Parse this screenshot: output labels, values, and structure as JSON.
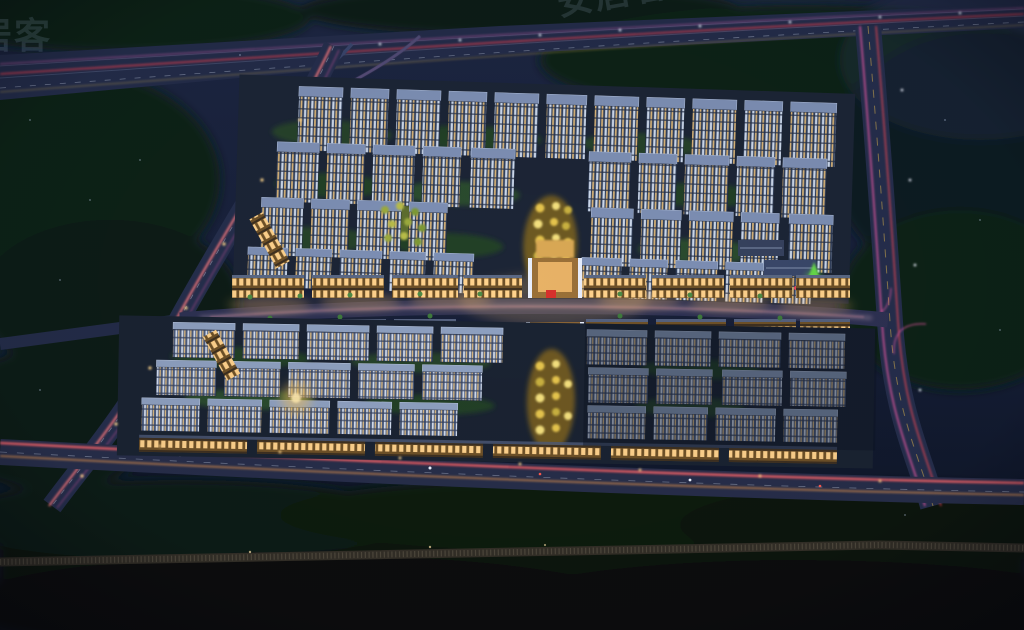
{
  "meta": {
    "type": "architectural-rendering",
    "description": "Night-time aerial bird's-eye rendering of a large residential compound: two blocks of illuminated high-rise apartment slabs separated by a warm-lit commercial street with entrance gates, golden landscaped axes, surrounded by roads with red and magenta car light trails, dark tree belts and a railway line at the bottom."
  },
  "watermark": {
    "text": "安居客",
    "color": "#a8c2e2"
  },
  "palette": {
    "sky_top": "#1d2642",
    "ground_dark": "#0b101d",
    "trees_dark": "#0e2016",
    "road": "#262f4e",
    "trail_red": "#ff4048",
    "trail_magenta": "#e858a8",
    "trail_orange": "#ffa24e",
    "facade_cool": "#cdd9ec",
    "window_warm": "#dbb577",
    "commercial_glow": "#ffbe6a",
    "axis_gold": "#e6c54e",
    "landmark_green": "#5fd447"
  },
  "scene": {
    "upper_block": "high-rise residential towers",
    "lower_block": "mid-rise residential rows",
    "commercial_street": "central lit shopping street",
    "north_gate": "north entrance gate",
    "south_gate": "south entrance gate",
    "railway": "railway line",
    "highway": "top highway",
    "front_road": "front road with light trails"
  }
}
